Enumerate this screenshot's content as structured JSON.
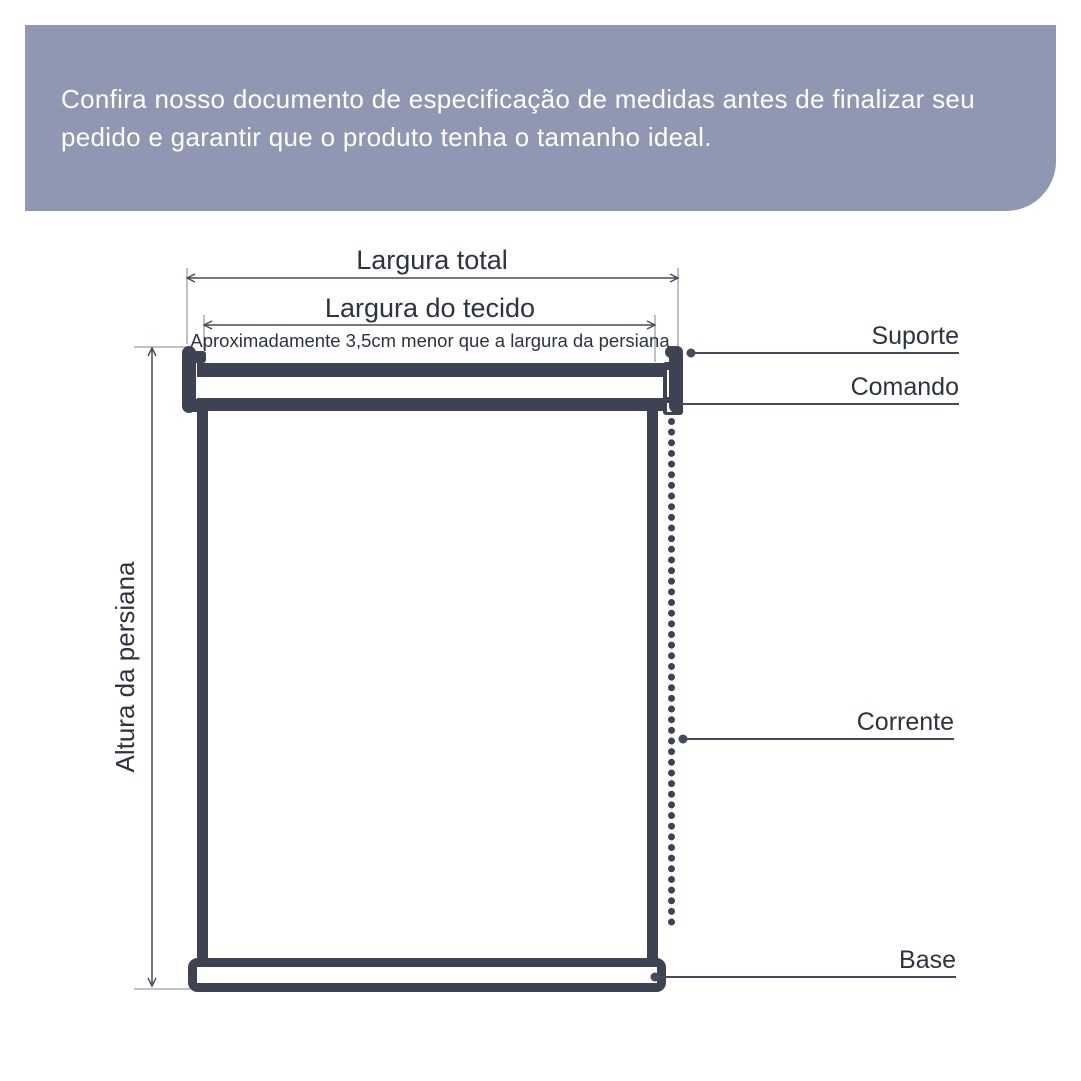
{
  "banner": {
    "lines": [
      "Confira nosso documento de especificação de medidas antes de finalizar seu",
      "pedido e garantir que o produto tenha o tamanho ideal."
    ],
    "background_color": "#9097B2",
    "text_color": "#FFFFFF"
  },
  "diagram": {
    "labels": {
      "largura_total": "Largura total",
      "largura_tecido": "Largura do tecido",
      "largura_tecido_nota": "Aproximadamente 3,5cm menor que a largura da persiana",
      "altura": "Altura da persiana",
      "suporte": "Suporte",
      "comando": "Comando",
      "corrente": "Corrente",
      "base": "Base"
    },
    "colors": {
      "part_fill": "#3D4353",
      "dimension_line": "#454B5C",
      "extension_line": "#9A9EA9",
      "label_text": "#2E3340"
    }
  }
}
